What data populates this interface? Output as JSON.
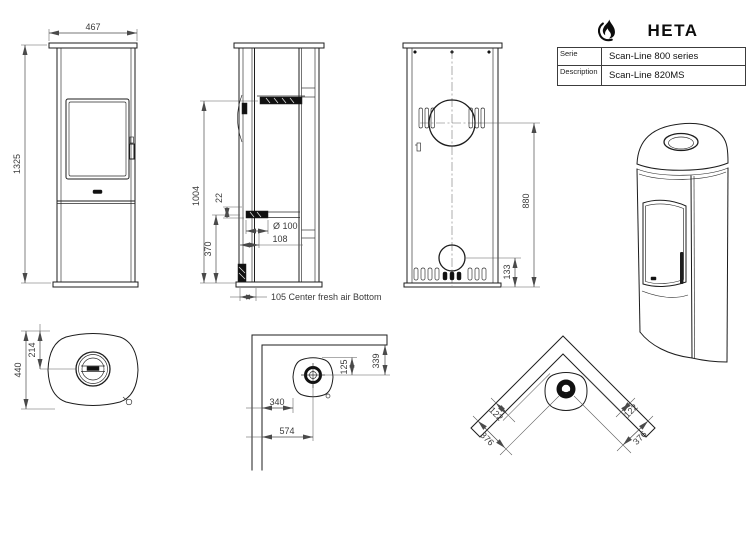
{
  "brand": {
    "logo_text": "HETA"
  },
  "spec_table": {
    "rows": [
      {
        "label": "Serie",
        "value": "Scan-Line 800 series"
      },
      {
        "label": "Description",
        "value": "Scan-Line 820MS"
      }
    ]
  },
  "views": {
    "front": {
      "width": "467",
      "height": "1325"
    },
    "side": {
      "height_to_outlet": "1004",
      "pipe_offset": "22",
      "pipe_center_height": "370",
      "pipe_diameter": "Ø 100",
      "pipe_center_depth": "108",
      "note": "105 Center fresh air Bottom"
    },
    "back": {
      "flue_center_height": "880",
      "fresh_air_center_height": "133"
    },
    "top": {
      "depth": "440",
      "flue_center_from_front": "214"
    },
    "wall_placement": {
      "wall_to_stove_side": "340",
      "wall_to_flue_center_side": "574",
      "stove_back_to_flue": "125",
      "wall_to_flue_center_back": "339"
    },
    "corner_placement": {
      "wall_to_stove_left": "122",
      "wall_to_stove_right": "122",
      "wall_to_flue_left": "376",
      "wall_to_flue_right": "376"
    }
  },
  "colors": {
    "line": "#1d1d1d",
    "dim_line": "#4a4a4a",
    "text": "#3a3a3a",
    "dark_fill": "#111111",
    "background": "#ffffff"
  }
}
